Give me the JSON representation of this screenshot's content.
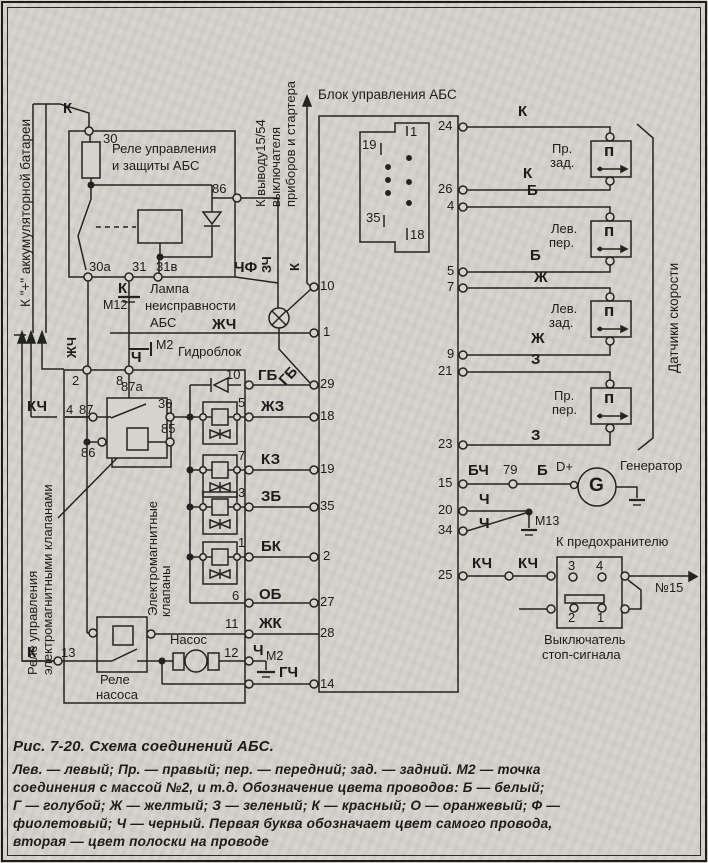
{
  "figure": {
    "title": "Рис. 7-20. Схема соединений АБС.",
    "caption_lines": [
      "Лев. — левый;   Пр. — правый;   пер. — передний;   зад. — задний.   М2 — точка",
      "соединения с массой №2, и т.д. Обозначение цвета проводов: Б — белый;",
      "Г — голубой;  Ж — желтый;  З — зеленый;  К — красный;  О — оранжевый;  Ф —",
      "фиолетовый;  Ч — черный.  Первая  буква  обозначает  цвет  самого  провода,",
      "вторая — цвет полоски на проводе"
    ]
  },
  "blocks": {
    "abs": "Блок управления АБС",
    "hydro": "Гидроблок",
    "rg1": "Реле управления",
    "rg2": "и защиты АБС",
    "lamp1": "Лампа",
    "lamp2": "неисправности",
    "lamp3": "АБС",
    "pump": "Насос",
    "pr1": "Реле",
    "pr2": "насоса",
    "gen": "Генератор",
    "g": "G",
    "dp": "D+",
    "fuse": "К предохранителю",
    "n15": "№15",
    "st1": "Выключатель",
    "st2": "стоп-сигнала",
    "batt": "К \"+\" аккумуляторной батареи",
    "ign1": "К выводу15/54",
    "ign2": "выключателя",
    "ign3": "приборов и стартера",
    "vr1": "Реле управления",
    "vr2": "электромагнитными клапанами",
    "ev1": "Электромагнитные",
    "ev2": "клапаны",
    "sensors": "Датчики скорости",
    "m2": "М2",
    "m12": "М12",
    "m13": "М13"
  },
  "w": {
    "K": "К",
    "B": "Б",
    "Zh": "Ж",
    "Z": "З",
    "Ch": "Ч",
    "KCh": "КЧ",
    "BCh": "БЧ",
    "ChF": "ЧФ",
    "ZCh": "ЗЧ",
    "ZhCh": "ЖЧ",
    "GB": "ГБ",
    "ZhZ": "ЖЗ",
    "KZ": "КЗ",
    "ZB": "ЗБ",
    "BK": "БК",
    "OB": "ОБ",
    "ZhK": "ЖК",
    "GCh": "ГЧ"
  },
  "pl": [
    "10",
    "1",
    "29",
    "18",
    "19",
    "35",
    "2",
    "27",
    "28",
    "14"
  ],
  "pr": [
    "24",
    "26",
    "4",
    "5",
    "7",
    "9",
    "21",
    "23",
    "15",
    "20",
    "34",
    "25"
  ],
  "t": {
    "n30": "30",
    "n86": "86",
    "n30a": "30а",
    "n31": "31",
    "n31v": "31в",
    "n2": "2",
    "n8": "8",
    "n87a": "87а",
    "n87": "87",
    "n86b": "86",
    "n30b": "30",
    "n85": "85",
    "n4": "4",
    "n13": "13",
    "n10": "10",
    "n5": "5",
    "n7": "7",
    "n3": "3",
    "n1": "1",
    "n6": "6",
    "n11": "11",
    "n12": "12",
    "n79": "79",
    "sw3": "3",
    "sw4": "4",
    "sw2": "2",
    "sw1": "1",
    "c1": "1",
    "c19": "19",
    "c35": "35",
    "c18": "18"
  },
  "s": {
    "pr": "Пр.",
    "lev": "Лев.",
    "per": "пер.",
    "zad": "зад.",
    "p": "п"
  }
}
